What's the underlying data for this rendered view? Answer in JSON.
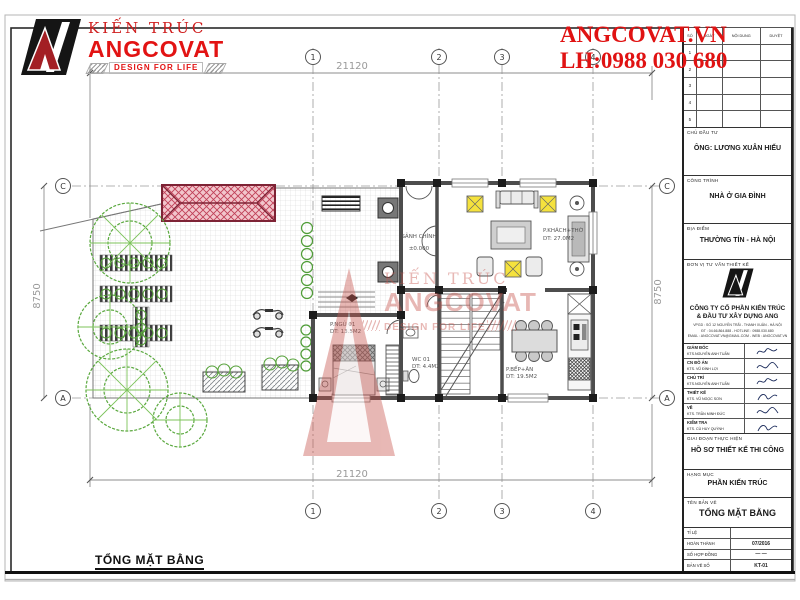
{
  "brand": {
    "architecture_label": "KIẾN TRÚC",
    "company_short": "ANGCOVAT",
    "tagline": "DESIGN FOR LIFE",
    "website": "ANGCOVAT.VN",
    "hotline": "LH:0988 030 680",
    "accent_red": "#e01212"
  },
  "sheet": {
    "bottom_title": "TỔNG MẶT BẰNG"
  },
  "plan": {
    "dim_top": "21120",
    "dim_bottom": "21120",
    "dim_left": "8750",
    "dim_right": "8750",
    "grid_cols": [
      "1",
      "2",
      "3",
      "4"
    ],
    "grid_rows": [
      "C",
      "A"
    ],
    "rooms": [
      {
        "name": "SẢNH CHÍNH",
        "sub": "±0.000"
      },
      {
        "name": "P.KHÁCH+THỜ",
        "sub": "DT: 27.0M2"
      },
      {
        "name": "P.NGỦ 01",
        "sub": "DT: 13.5M2"
      },
      {
        "name": "WC 01",
        "sub": "DT: 4.4M2"
      },
      {
        "name": "P.BẾP+ĂN",
        "sub": "DT: 19.5M2"
      }
    ],
    "watermark": {
      "line1": "KIẾN TRÚC",
      "line2": "ANGCOVAT",
      "line3": "DESIGN FOR LIFE"
    }
  },
  "titleblock": {
    "revisions": {
      "headers": [
        "SỐ",
        "NGÀY",
        "NỘI DUNG",
        "DUYỆT"
      ],
      "rows": [
        "1",
        "2",
        "3",
        "4",
        "5"
      ]
    },
    "chu_dau_tu": {
      "label": "CHỦ ĐẦU TƯ",
      "value": "ÔNG: LƯƠNG XUÂN HIẾU"
    },
    "cong_trinh": {
      "label": "CÔNG TRÌNH",
      "value": "NHÀ Ở GIA ĐÌNH"
    },
    "dia_diem": {
      "label": "ĐỊA ĐIỂM",
      "value": "THƯỜNG TÍN - HÀ NỘI"
    },
    "don_vi": {
      "label": "ĐƠN VỊ TƯ VẤN THIẾT KẾ",
      "company_line1": "CÔNG TY CỔ PHẦN KIẾN TRÚC",
      "company_line2": "& ĐẦU TƯ XÂY DỰNG ANG",
      "contact1": "VPGD : SỐ 12 NGUYỄN TRÃI - THANH XUÂN - HÀ NỘI",
      "contact2": "ĐT : 04.66.864.888 - HOTLINE : 0988.030.680",
      "contact3": "EMAIL : ANGCOVAT.VN@GMAIL.COM - WEB : ANGCOVAT.VN"
    },
    "signers": [
      {
        "role": "GIÁM ĐỐC",
        "name": "KTS.NGUYỄN ANH TUẤN"
      },
      {
        "role": "CN ĐỒ ÁN",
        "name": "KTS. VŨ ĐÌNH LỢI"
      },
      {
        "role": "CHỦ TRÌ",
        "name": "KTS.NGUYỄN ANH TUẤN"
      },
      {
        "role": "THIẾT KẾ",
        "name": "KTS. VŨ NGỌC SƠN"
      },
      {
        "role": "VẼ",
        "name": "KTS. TRẦN MINH ĐỨC"
      },
      {
        "role": "KIỂM TRA",
        "name": "KTS. CÙ HUY QUỲNH"
      }
    ],
    "giai_doan": {
      "label": "GIAI ĐOẠN THỰC HIỆN",
      "value": "HỒ SƠ THIẾT KẾ THI CÔNG"
    },
    "hang_muc": {
      "label": "HẠNG MỤC",
      "value": "PHẦN KIẾN TRÚC"
    },
    "ten_ban_ve": {
      "label": "TÊN BẢN VẼ",
      "value": "TỔNG MẶT BẰNG"
    },
    "info_rows": [
      {
        "label": "TỈ LỆ",
        "value": ""
      },
      {
        "label": "HOÀN THÀNH",
        "value": "07/2016"
      },
      {
        "label": "SỐ HỢP ĐỒNG",
        "value": "— —"
      },
      {
        "label": "BẢN VẼ SỐ",
        "value": "KT-01"
      }
    ]
  }
}
